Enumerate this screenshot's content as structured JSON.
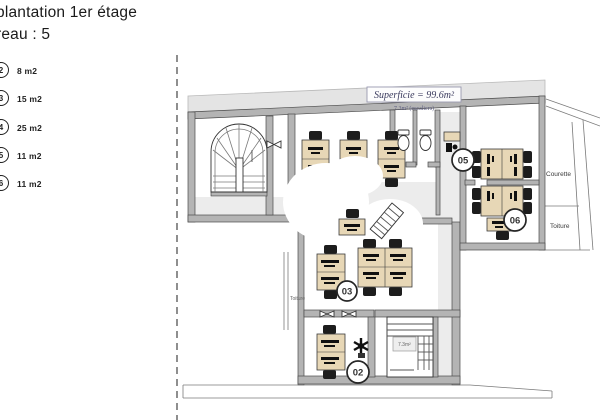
{
  "header": {
    "line1": "plantation 1er étage",
    "line2": "reau : 5"
  },
  "legend": {
    "items": [
      {
        "number": "2",
        "area": "8 m2"
      },
      {
        "number": "3",
        "area": "15 m2"
      },
      {
        "number": "4",
        "area": "25 m2"
      },
      {
        "number": "5",
        "area": "11 m2"
      },
      {
        "number": "6",
        "area": "11 m2"
      }
    ]
  },
  "plan": {
    "superficie": {
      "label": "Superficie = 99.6m²",
      "sub": "7.3m² (escaliers)"
    },
    "areas": {
      "courette": "Courette",
      "toiture_right": "Toiture",
      "toiture_left": "Toiture",
      "stair_label": "7.3m²"
    },
    "markers": [
      {
        "id": "02"
      },
      {
        "id": "03"
      },
      {
        "id": "05"
      },
      {
        "id": "06"
      }
    ]
  },
  "colors": {
    "wall": "#b4b4b4",
    "roof_band": "#e4e4e4",
    "desk": "#e7d7b6",
    "chair": "#1d1d1d",
    "label_navy": "#3b3b5e",
    "marker_stroke": "#262626"
  }
}
